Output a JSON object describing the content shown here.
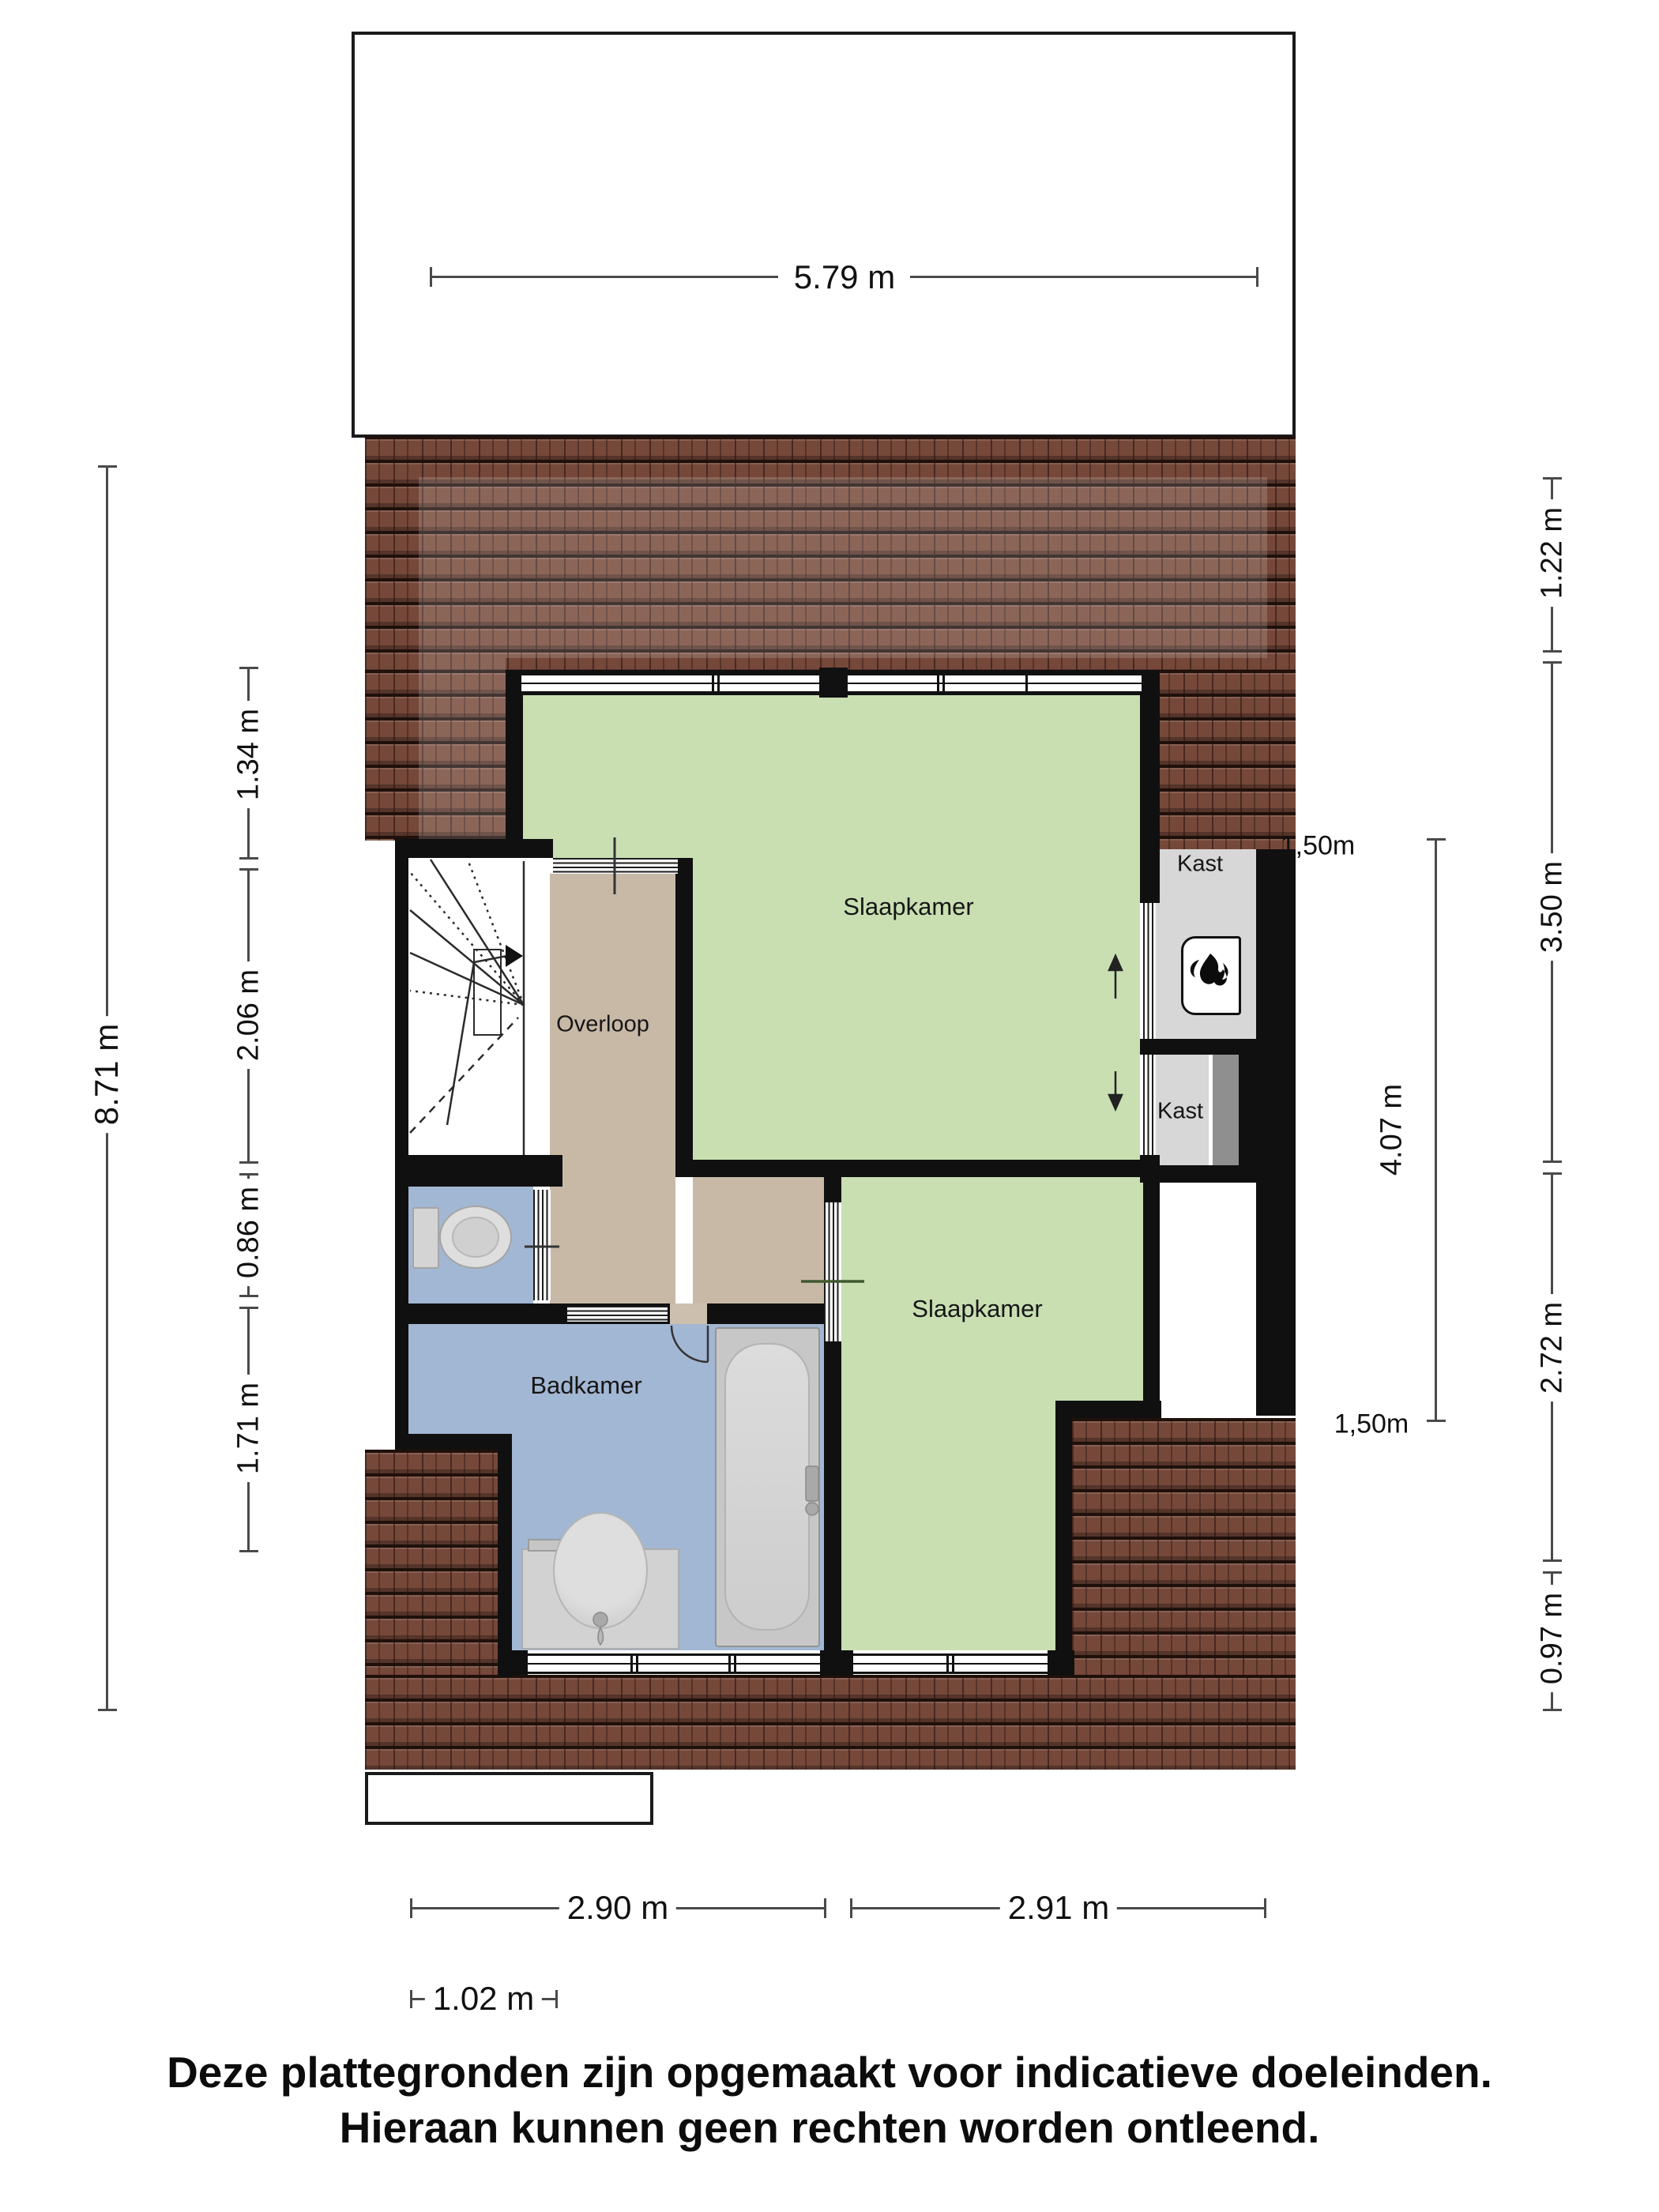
{
  "plan": {
    "rooms": {
      "slaapkamer_top": "Slaapkamer",
      "slaapkamer_bottom": "Slaapkamer",
      "overloop": "Overloop",
      "badkamer": "Badkamer",
      "kast_top": "Kast",
      "kast_bottom": "Kast"
    },
    "dimensions": {
      "top_width": "5.79 m",
      "left_total": "8.71 m",
      "left_segments": [
        "1.34 m",
        "2.06 m",
        "0.86 m",
        "1.71 m"
      ],
      "right_segments": [
        "1.22 m",
        "3.50 m",
        "2.72 m",
        "0.97 m"
      ],
      "right_inner": "4.07 m",
      "headroom_top": "1,50m",
      "headroom_bottom": "1,50m",
      "bottom_left": "2.90 m",
      "bottom_right": "2.91 m",
      "bottom_offset": "1.02 m"
    },
    "colors": {
      "bedroom": "#c9dfb2",
      "hallway": "#c8b9a7",
      "bathroom": "#a2b7d3",
      "closet": "#d7d7d7",
      "roof": "#76483a",
      "wall": "#101010"
    }
  },
  "footer": {
    "line1": "Deze plattegronden zijn opgemaakt voor indicatieve doeleinden.",
    "line2": "Hieraan kunnen geen rechten worden ontleend."
  }
}
